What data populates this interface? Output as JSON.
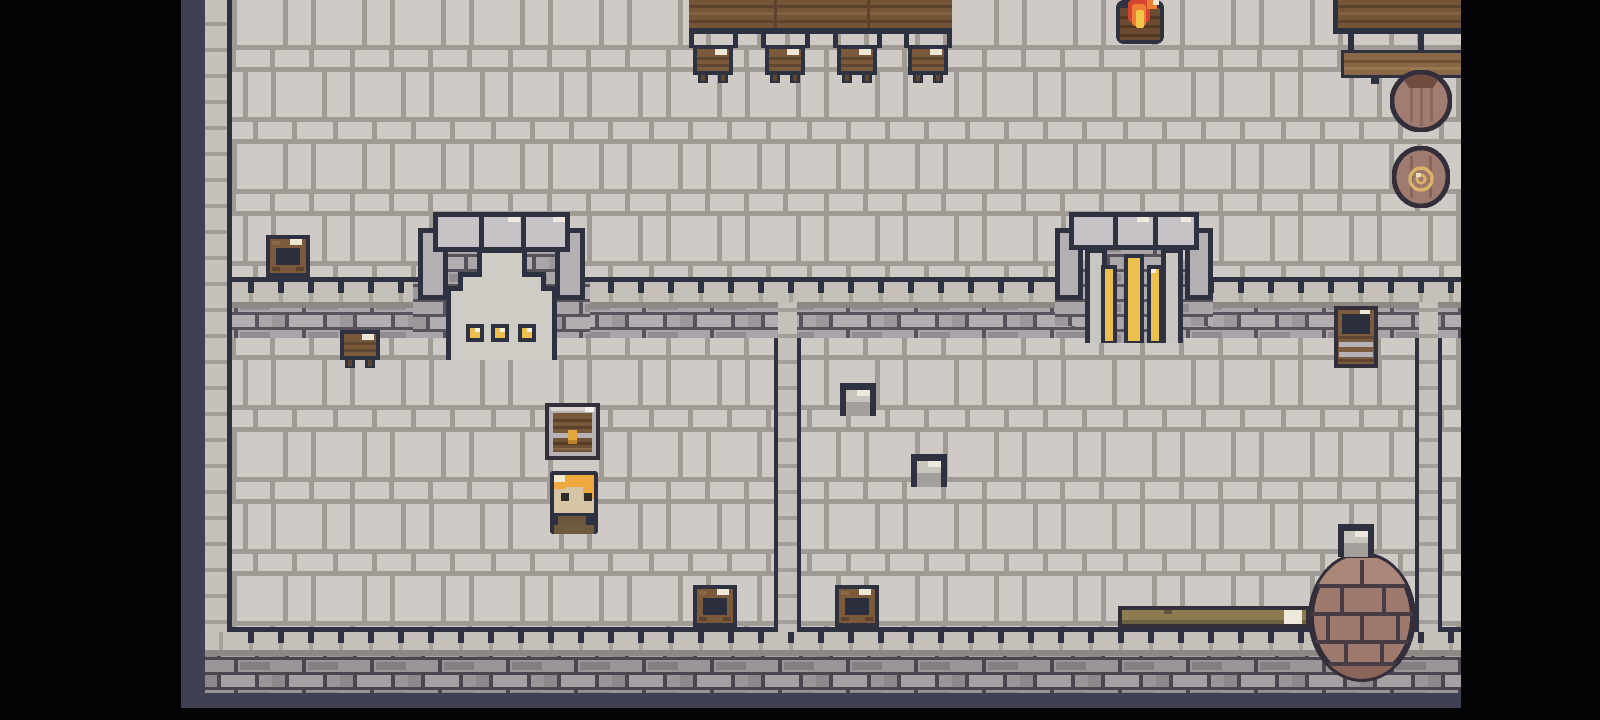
{
  "app": {
    "description": "top-down pixel-art castle interior game scene",
    "visible_text": []
  },
  "palette": {
    "letterbox_black": "#040406",
    "gutter_purple": "#3f4152",
    "outline_dark": "#2e3140",
    "floor_tile": "#cfcac5",
    "floor_grout": "#a19b95",
    "band_light_row": "#c5c0ba",
    "band_shadow": "#8d8883",
    "brick_face": "#a9a5a8",
    "brick_grout": "#57525b",
    "wood_dark": "#745538",
    "wood_mid": "#7b5a3c",
    "wood_light": "#8a6847",
    "metal_silver": "#b5b1b4",
    "navy_interior": "#2b2e3c",
    "gold": "#ecbf4e",
    "flame_red": "#d64330",
    "flame_orange": "#ee7e31",
    "flame_yellow": "#f3c64a",
    "hair_gold": "#f0a93f",
    "skin": "#d6c5a4",
    "clay_pot": "#a17d71",
    "well_brick": "#9d7a6d",
    "glint_ivory": "#efe8d9"
  },
  "scene": {
    "viewport": {
      "width": 1600,
      "height": 720
    },
    "regions": [
      {
        "name": "backdrop",
        "fill": "black",
        "x": 0,
        "y": 0,
        "w": 1600,
        "h": 720,
        "interactable": false
      },
      {
        "name": "gutter-left",
        "fill": "purple",
        "x": 181,
        "y": 0,
        "w": 25,
        "h": 708,
        "interactable": false
      },
      {
        "name": "gutter-bottom",
        "fill": "purple",
        "x": 181,
        "y": 693,
        "w": 1280,
        "h": 15,
        "interactable": false
      },
      {
        "name": "outer-wall-column",
        "fill": "col",
        "x": 205,
        "y": 0,
        "w": 22,
        "h": 632,
        "interactable": false
      },
      {
        "name": "hall-floor",
        "fill": "floor",
        "x": 227,
        "y": 0,
        "w": 1234,
        "h": 277,
        "interactable": false
      },
      {
        "name": "rooms-floor",
        "fill": "floor",
        "x": 227,
        "y": 338,
        "w": 1234,
        "h": 289,
        "interactable": false
      },
      {
        "name": "south-hall-wall-top-row",
        "fill": "light",
        "x": 227,
        "y": 282,
        "w": 1234,
        "h": 20,
        "interactable": false
      },
      {
        "name": "south-hall-wall-shadow",
        "fill": "shadow",
        "x": 227,
        "y": 302,
        "w": 1234,
        "h": 6,
        "interactable": false
      },
      {
        "name": "south-hall-wall-bricks",
        "fill": "band",
        "x": 227,
        "y": 308,
        "w": 1234,
        "h": 30,
        "interactable": false
      },
      {
        "name": "bottom-wall-top-row",
        "fill": "light",
        "x": 205,
        "y": 632,
        "w": 1256,
        "h": 18,
        "interactable": false
      },
      {
        "name": "bottom-wall-shadow",
        "fill": "shadow",
        "x": 205,
        "y": 650,
        "w": 1256,
        "h": 6,
        "interactable": false
      },
      {
        "name": "bottom-wall-bricks",
        "fill": "bandDark",
        "x": 205,
        "y": 656,
        "w": 1256,
        "h": 37,
        "interactable": false
      },
      {
        "name": "west-wall-line",
        "fill": "line",
        "x": 227,
        "y": 0,
        "w": 5,
        "h": 632,
        "interactable": false
      },
      {
        "name": "hall-wall-line",
        "fill": "line",
        "x": 227,
        "y": 277,
        "w": 1234,
        "h": 5,
        "interactable": false
      },
      {
        "name": "hall-wall-ticks",
        "fill": "ticks",
        "x": 227,
        "y": 282,
        "w": 1234,
        "h": 11,
        "interactable": false
      },
      {
        "name": "bottom-wall-line",
        "fill": "line",
        "x": 227,
        "y": 627,
        "w": 1234,
        "h": 5,
        "interactable": false
      },
      {
        "name": "bottom-wall-ticks",
        "fill": "ticks",
        "x": 227,
        "y": 632,
        "w": 1234,
        "h": 11,
        "interactable": false
      },
      {
        "name": "room-divider-column",
        "fill": "col",
        "x": 778,
        "y": 302,
        "w": 19,
        "h": 330,
        "interactable": false
      },
      {
        "name": "room-divider-line-west",
        "fill": "line",
        "x": 774,
        "y": 338,
        "w": 4,
        "h": 294,
        "interactable": false
      },
      {
        "name": "room-divider-line-east",
        "fill": "line",
        "x": 797,
        "y": 338,
        "w": 4,
        "h": 294,
        "interactable": false
      },
      {
        "name": "east-divider-column",
        "fill": "col",
        "x": 1419,
        "y": 302,
        "w": 19,
        "h": 330,
        "interactable": false
      },
      {
        "name": "east-divider-line-west",
        "fill": "line",
        "x": 1415,
        "y": 338,
        "w": 4,
        "h": 294,
        "interactable": false
      },
      {
        "name": "east-divider-line-east",
        "fill": "line",
        "x": 1438,
        "y": 338,
        "w": 4,
        "h": 294,
        "interactable": false
      },
      {
        "name": "cursor-speck",
        "fill": "speck",
        "x": 7,
        "y": 366,
        "w": 4,
        "h": 3,
        "interactable": false
      },
      {
        "name": "letterbox-right",
        "fill": "black",
        "x": 1461,
        "y": 0,
        "w": 139,
        "h": 720,
        "interactable": false
      },
      {
        "name": "letterbox-bottom",
        "fill": "black",
        "x": 0,
        "y": 708,
        "w": 1600,
        "h": 12,
        "interactable": false
      },
      {
        "name": "letterbox-left",
        "fill": "black",
        "x": 0,
        "y": 0,
        "w": 181,
        "h": 720,
        "interactable": false
      }
    ],
    "entities": [
      {
        "name": "banquet-table",
        "symbol": "table",
        "x": 689,
        "y": 0,
        "w": 263,
        "h": 48,
        "interactable": false
      },
      {
        "name": "stool-1",
        "symbol": "stool",
        "x": 693,
        "y": 45,
        "w": 40,
        "h": 38,
        "interactable": false
      },
      {
        "name": "stool-2",
        "symbol": "stool",
        "x": 765,
        "y": 45,
        "w": 40,
        "h": 38,
        "interactable": false
      },
      {
        "name": "stool-3",
        "symbol": "stool",
        "x": 837,
        "y": 45,
        "w": 40,
        "h": 38,
        "interactable": false
      },
      {
        "name": "stool-4",
        "symbol": "stool",
        "x": 908,
        "y": 45,
        "w": 40,
        "h": 38,
        "interactable": false
      },
      {
        "name": "brazier-fire",
        "symbol": "fire",
        "x": 1116,
        "y": 0,
        "w": 48,
        "h": 44,
        "interactable": true
      },
      {
        "name": "side-table",
        "symbol": "plankTable",
        "x": 1333,
        "y": 0,
        "w": 128,
        "h": 50,
        "interactable": false
      },
      {
        "name": "side-bench",
        "symbol": "plankSeat",
        "x": 1341,
        "y": 50,
        "w": 120,
        "h": 34,
        "interactable": false
      },
      {
        "name": "clay-pot",
        "symbol": "barrelTop",
        "x": 1390,
        "y": 70,
        "w": 62,
        "h": 62,
        "interactable": true
      },
      {
        "name": "rope-coil-pot",
        "symbol": "barrelCoil",
        "x": 1392,
        "y": 146,
        "w": 58,
        "h": 62,
        "interactable": true
      },
      {
        "name": "hall-chest",
        "symbol": "chestOpen",
        "x": 266,
        "y": 235,
        "w": 44,
        "h": 42,
        "interactable": true
      },
      {
        "name": "north-doorway",
        "symbol": "archDoor",
        "x": 413,
        "y": 212,
        "w": 177,
        "h": 148,
        "interactable": true
      },
      {
        "name": "golden-gate",
        "symbol": "archGate",
        "x": 1055,
        "y": 212,
        "w": 158,
        "h": 131,
        "interactable": true
      },
      {
        "name": "band-stool",
        "symbol": "stool",
        "x": 340,
        "y": 330,
        "w": 40,
        "h": 38,
        "interactable": false
      },
      {
        "name": "open-barrel",
        "symbol": "crate",
        "x": 1334,
        "y": 306,
        "w": 44,
        "h": 62,
        "interactable": true
      },
      {
        "name": "supply-chest",
        "symbol": "chestLatch",
        "x": 545,
        "y": 403,
        "w": 55,
        "h": 57,
        "interactable": true
      },
      {
        "name": "villager",
        "symbol": "hero",
        "x": 550,
        "y": 471,
        "w": 48,
        "h": 63,
        "interactable": true
      },
      {
        "name": "stone-block-1",
        "symbol": "stoneBlock",
        "x": 840,
        "y": 383,
        "w": 36,
        "h": 33,
        "interactable": false
      },
      {
        "name": "stone-block-2",
        "symbol": "stoneBlock",
        "x": 911,
        "y": 454,
        "w": 36,
        "h": 33,
        "interactable": false
      },
      {
        "name": "floor-chest-left",
        "symbol": "chestOpen",
        "x": 693,
        "y": 585,
        "w": 44,
        "h": 42,
        "interactable": true
      },
      {
        "name": "floor-chest-right",
        "symbol": "chestOpen",
        "x": 835,
        "y": 585,
        "w": 44,
        "h": 42,
        "interactable": true
      },
      {
        "name": "well",
        "symbol": "well",
        "x": 1306,
        "y": 550,
        "w": 112,
        "h": 135,
        "interactable": true
      },
      {
        "name": "stone-block-3",
        "symbol": "stoneBlock",
        "x": 1338,
        "y": 523,
        "w": 36,
        "h": 35,
        "interactable": false
      },
      {
        "name": "wooden-beam",
        "symbol": "beam",
        "x": 1118,
        "y": 606,
        "w": 192,
        "h": 22,
        "interactable": false
      }
    ]
  }
}
